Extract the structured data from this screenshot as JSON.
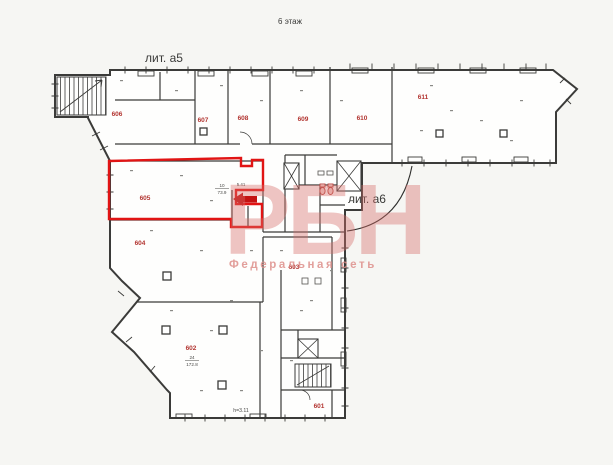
{
  "header": {
    "floor_label": "6 этаж"
  },
  "wings": {
    "a5_label": "лит. а5",
    "a6_label": "лит. а6"
  },
  "rooms": {
    "r601": {
      "number": "601"
    },
    "r602": {
      "number": "602"
    },
    "r603": {
      "number": "603"
    },
    "r604": {
      "number": "604"
    },
    "r605": {
      "number": "605"
    },
    "r606": {
      "number": "606"
    },
    "r607": {
      "number": "607"
    },
    "r608": {
      "number": "608"
    },
    "r609": {
      "number": "609"
    },
    "r610": {
      "number": "610"
    },
    "r611": {
      "number": "611"
    }
  },
  "room_details": {
    "r605": {
      "plan_number": "10",
      "area": "73.9"
    },
    "r602": {
      "plan_number": "24",
      "area": "172.8"
    }
  },
  "notes": {
    "lobby_dim": "5.41",
    "ceiling_height": "h=3.11"
  },
  "highlight": {
    "room": "605",
    "outline_color": "#e11414",
    "arrow_color": "#c41212"
  },
  "watermark": {
    "logo_text": "РБН",
    "tagline": "Федеральная сеть"
  },
  "colors": {
    "wall": "#3b3b39",
    "room_label": "#b23430",
    "paper": "#f6f6f3",
    "watermark_pink": "#d86d68",
    "dim_text": "#4a4a48"
  }
}
